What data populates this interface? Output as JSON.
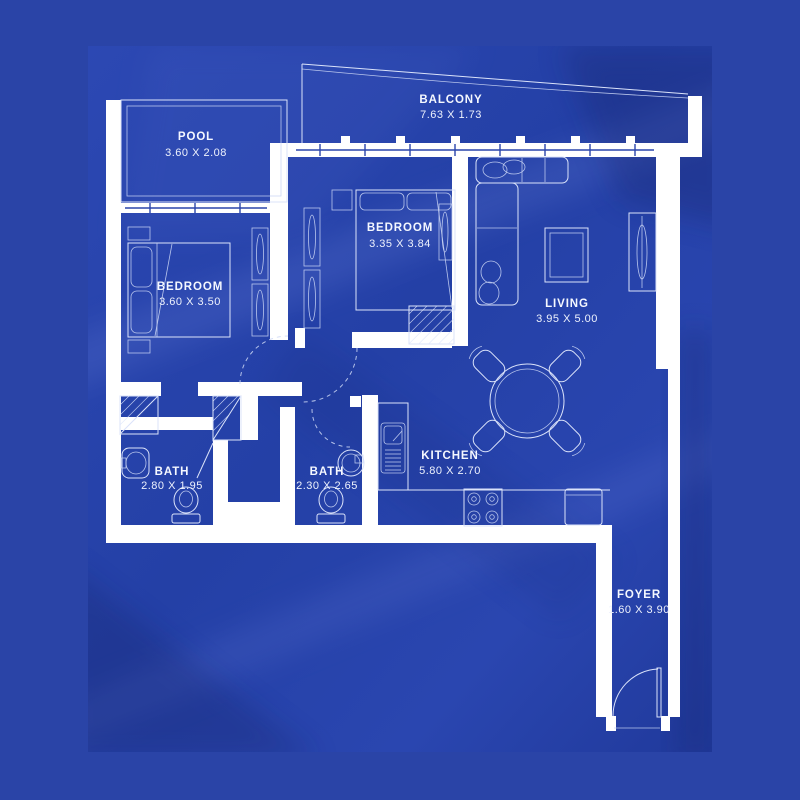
{
  "palette": {
    "background_outer": "#2a44a7",
    "background_panel": "#2643ad",
    "fold_highlight": "#4f67c6",
    "fold_shadow": "#16297d",
    "wall": "#ffffff",
    "linework": "#dbe3fa",
    "label_text": "#f5f8ff"
  },
  "rooms": [
    {
      "id": "pool",
      "name": "POOL",
      "dims": "3.60 X 2.08"
    },
    {
      "id": "balcony",
      "name": "BALCONY",
      "dims": "7.63 X 1.73"
    },
    {
      "id": "bedroom-1",
      "name": "BEDROOM",
      "dims": "3.60 X 3.50"
    },
    {
      "id": "bedroom-2",
      "name": "BEDROOM",
      "dims": "3.35 X 3.84"
    },
    {
      "id": "living",
      "name": "LIVING",
      "dims": "3.95 X 5.00"
    },
    {
      "id": "kitchen",
      "name": "KITCHEN",
      "dims": "5.80 X 2.70"
    },
    {
      "id": "bath-1",
      "name": "BATH",
      "dims": "2.80 X 1.95"
    },
    {
      "id": "bath-2",
      "name": "BATH",
      "dims": "2.30 X 2.65"
    },
    {
      "id": "foyer",
      "name": "FOYER",
      "dims": "1.60 X 3.90"
    }
  ]
}
